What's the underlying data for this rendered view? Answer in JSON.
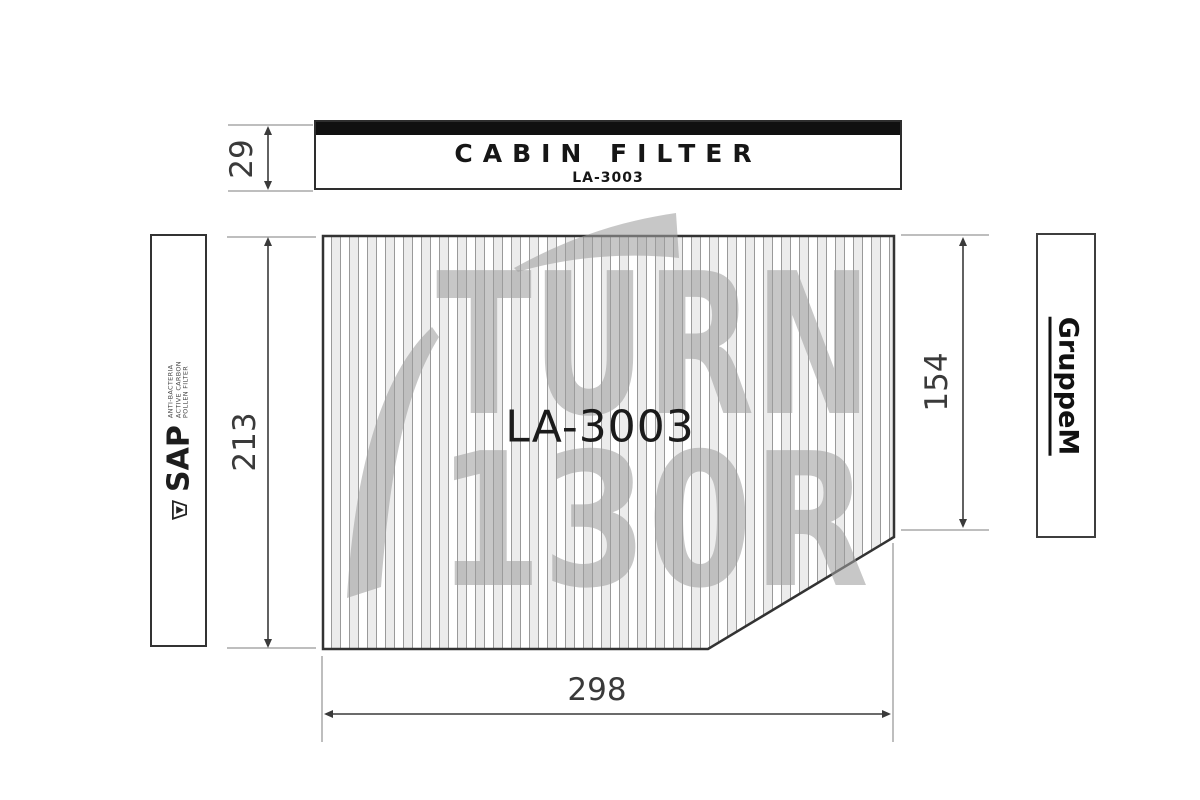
{
  "product": {
    "title": "CABIN FILTER",
    "part_number": "LA-3003",
    "printed_code": "LA-3003"
  },
  "dimensions": {
    "label_height_mm": "29",
    "filter_height_mm": "213",
    "right_edge_height_mm": "154",
    "filter_width_mm": "298"
  },
  "left_panel": {
    "brand": "SAP",
    "logo_icon": "funnel-drop-icon",
    "fine_print_lines": [
      "ANTI-BACTERIA",
      "ACTIVE CARBON",
      "POLLEN FILTER"
    ]
  },
  "right_panel": {
    "brand": "GruppeM"
  },
  "watermark": {
    "line1": "TURN",
    "line2": "130R"
  },
  "colors": {
    "line_dark": "#3a3a3a",
    "extension_gray": "#a8a8a8",
    "pleat_line": "#9a9a9a",
    "pleat_alt_fill": "#ececec",
    "watermark_gray": "#9e9e9e",
    "label_bar_black": "#101010"
  }
}
